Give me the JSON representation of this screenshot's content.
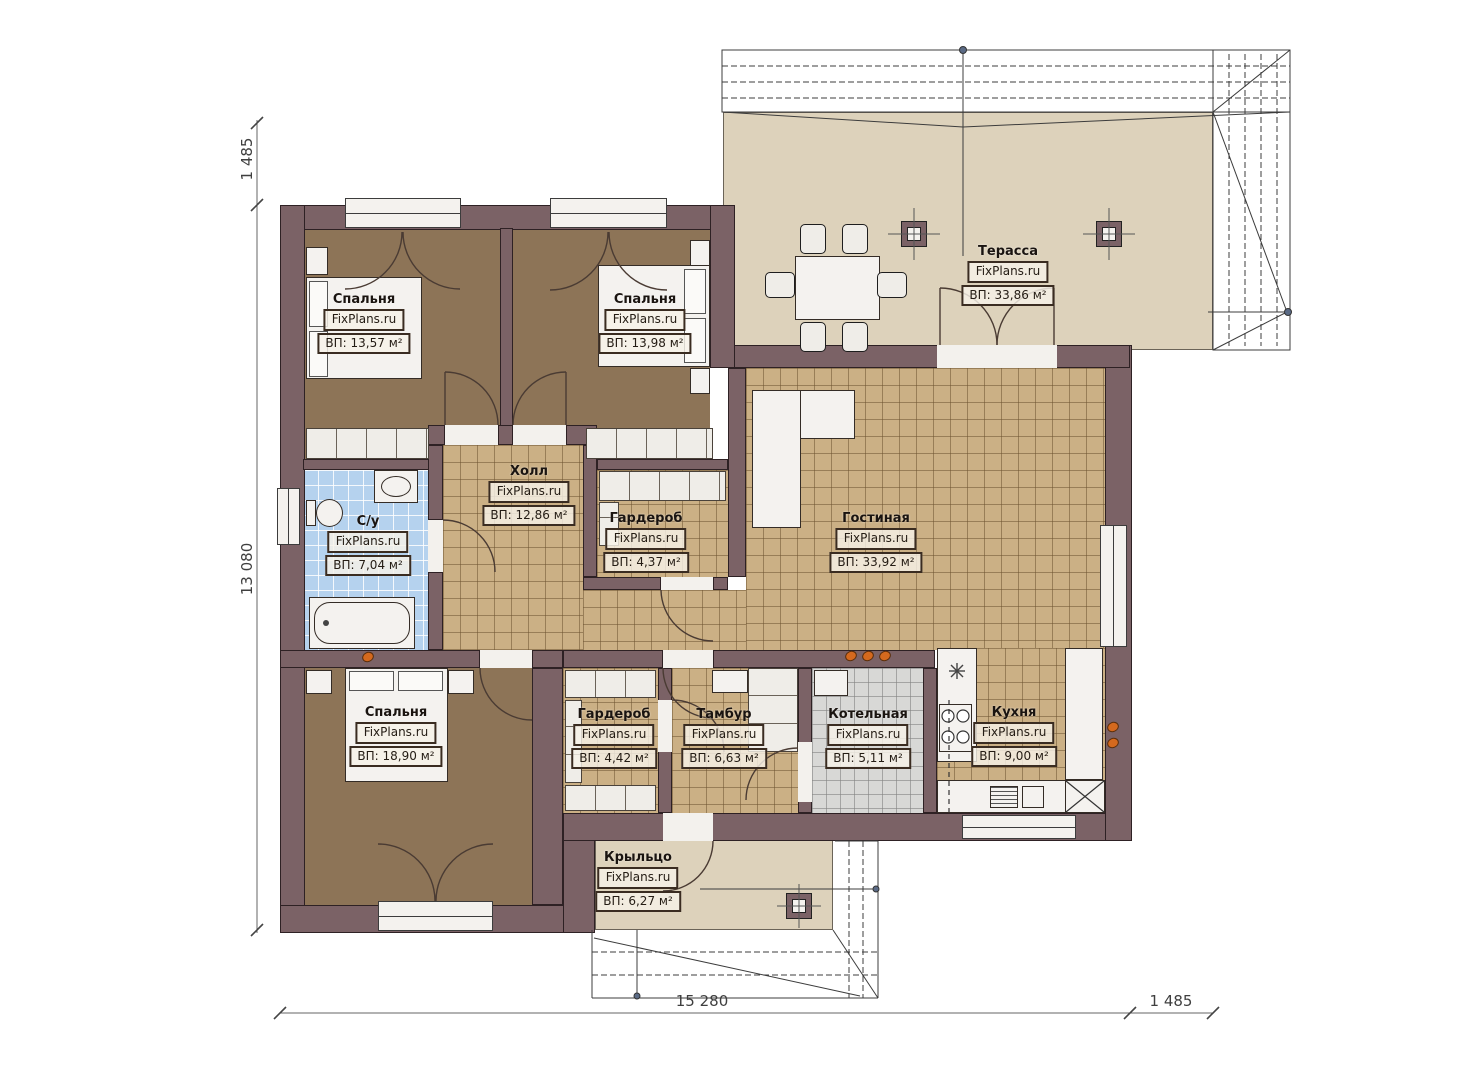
{
  "brand": "FixPlans.ru",
  "plan_title": "Floor plan of a single-storey house",
  "rooms": [
    {
      "id": "bedroom-top-left",
      "name": "Спальня",
      "area": "ВП: 13,57 м²"
    },
    {
      "id": "bedroom-top-right",
      "name": "Спальня",
      "area": "ВП: 13,98 м²"
    },
    {
      "id": "terrace",
      "name": "Терасса",
      "area": "ВП: 33,86 м²"
    },
    {
      "id": "hall",
      "name": "Холл",
      "area": "ВП: 12,86 м²"
    },
    {
      "id": "bathroom",
      "name": "С/у",
      "area": "ВП: 7,04 м²"
    },
    {
      "id": "wardrobe-top",
      "name": "Гардероб",
      "area": "ВП: 4,37 м²"
    },
    {
      "id": "living-room",
      "name": "Гостиная",
      "area": "ВП: 33,92 м²"
    },
    {
      "id": "bedroom-bottom",
      "name": "Спальня",
      "area": "ВП: 18,90 м²"
    },
    {
      "id": "wardrobe-bottom",
      "name": "Гардероб",
      "area": "ВП: 4,42 м²"
    },
    {
      "id": "vestibule",
      "name": "Тамбур",
      "area": "ВП: 6,63 м²"
    },
    {
      "id": "boiler-room",
      "name": "Котельная",
      "area": "ВП: 5,11 м²"
    },
    {
      "id": "kitchen",
      "name": "Кухня",
      "area": "ВП: 9,00 м²"
    },
    {
      "id": "porch",
      "name": "Крыльцо",
      "area": "ВП: 6,27 м²"
    }
  ],
  "dimensions": {
    "left_top": "1 485",
    "left_side": "13 080",
    "bottom_main": "15 280",
    "bottom_right": "1 485"
  },
  "symbols": {
    "fridge": "snowflake-icon",
    "appliance_cross": "x-box-icon",
    "columns": "column-cross-icon"
  },
  "colors": {
    "wall": "#7b6266",
    "tile_beige": "#cbb085",
    "tile_blue": "#b5d2ee",
    "tile_gray": "#d8d8d6",
    "bedroom_floor": "#8d7457",
    "terrace_floor": "#ddd2bb",
    "vent_accent": "#d4691e"
  }
}
